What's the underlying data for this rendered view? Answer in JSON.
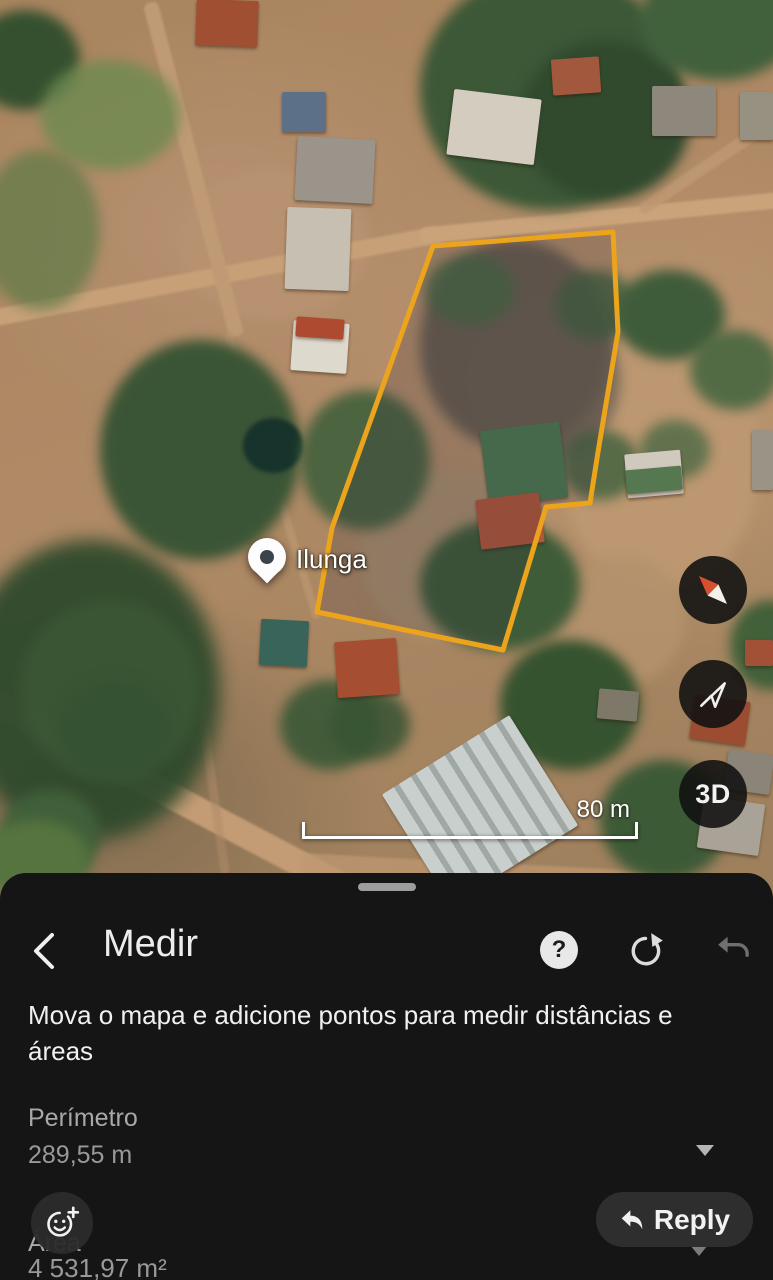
{
  "map": {
    "marker_label": "Ilunga",
    "scale_label": "80 m",
    "buttons": {
      "three_d": "3D"
    },
    "polygon_color": "#ebа41c"
  },
  "sheet": {
    "title": "Medir",
    "instruction": "Mova o mapa e adicione pontos para medir distâncias e áreas",
    "help_glyph": "?",
    "perimeter": {
      "label": "Perímetro",
      "value": "289,55 m"
    },
    "area": {
      "label": "Área",
      "value": "4 531,97 m²"
    }
  },
  "overlay": {
    "reply_label": "Reply"
  },
  "icons": {
    "back": "chevron-left",
    "help": "question-mark-circle",
    "redo": "redo-arrow",
    "undo": "undo-arrow",
    "perimeter_dropdown": "triangle-down",
    "area_dropdown": "triangle-down",
    "reaction": "smiley-plus",
    "reply": "reply-arrow",
    "compass": "compass-needle",
    "my_location": "navigation-arrow",
    "marker": "map-pin"
  },
  "colors": {
    "accent_yellow": "#eba41c",
    "sheet_background": "#151515",
    "muted_text": "#9a9a9a"
  }
}
